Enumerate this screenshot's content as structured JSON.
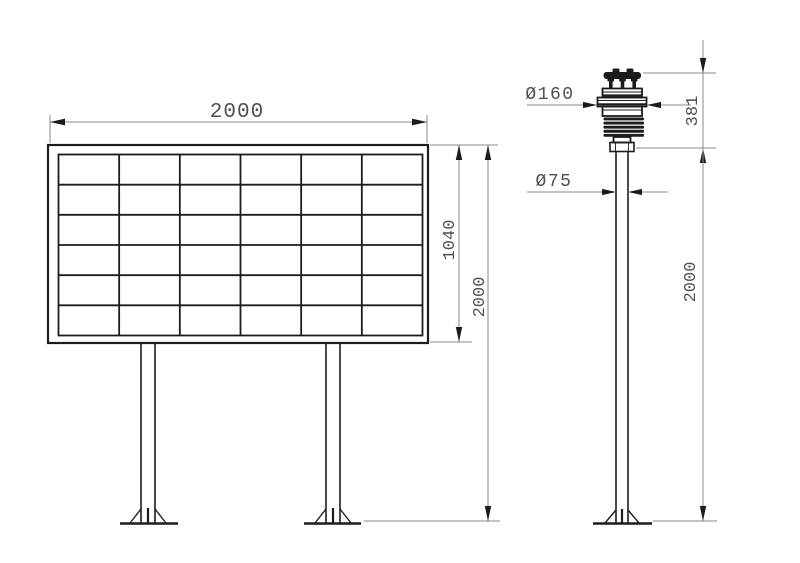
{
  "colors": {
    "structure_line": "#1c1c1c",
    "dimension_line": "#8a8a8a",
    "dimension_text": "#4f4f4f",
    "background": "#ffffff"
  },
  "display_board": {
    "grid": {
      "columns": 6,
      "rows": 6
    },
    "dim_width": "2000",
    "dim_panel_height": "1040",
    "dim_total_height": "2000"
  },
  "sensor_pole": {
    "dim_sensor_diameter": "Ø160",
    "dim_sensor_height": "381",
    "dim_pole_diameter": "Ø75",
    "dim_pole_height": "2000"
  }
}
